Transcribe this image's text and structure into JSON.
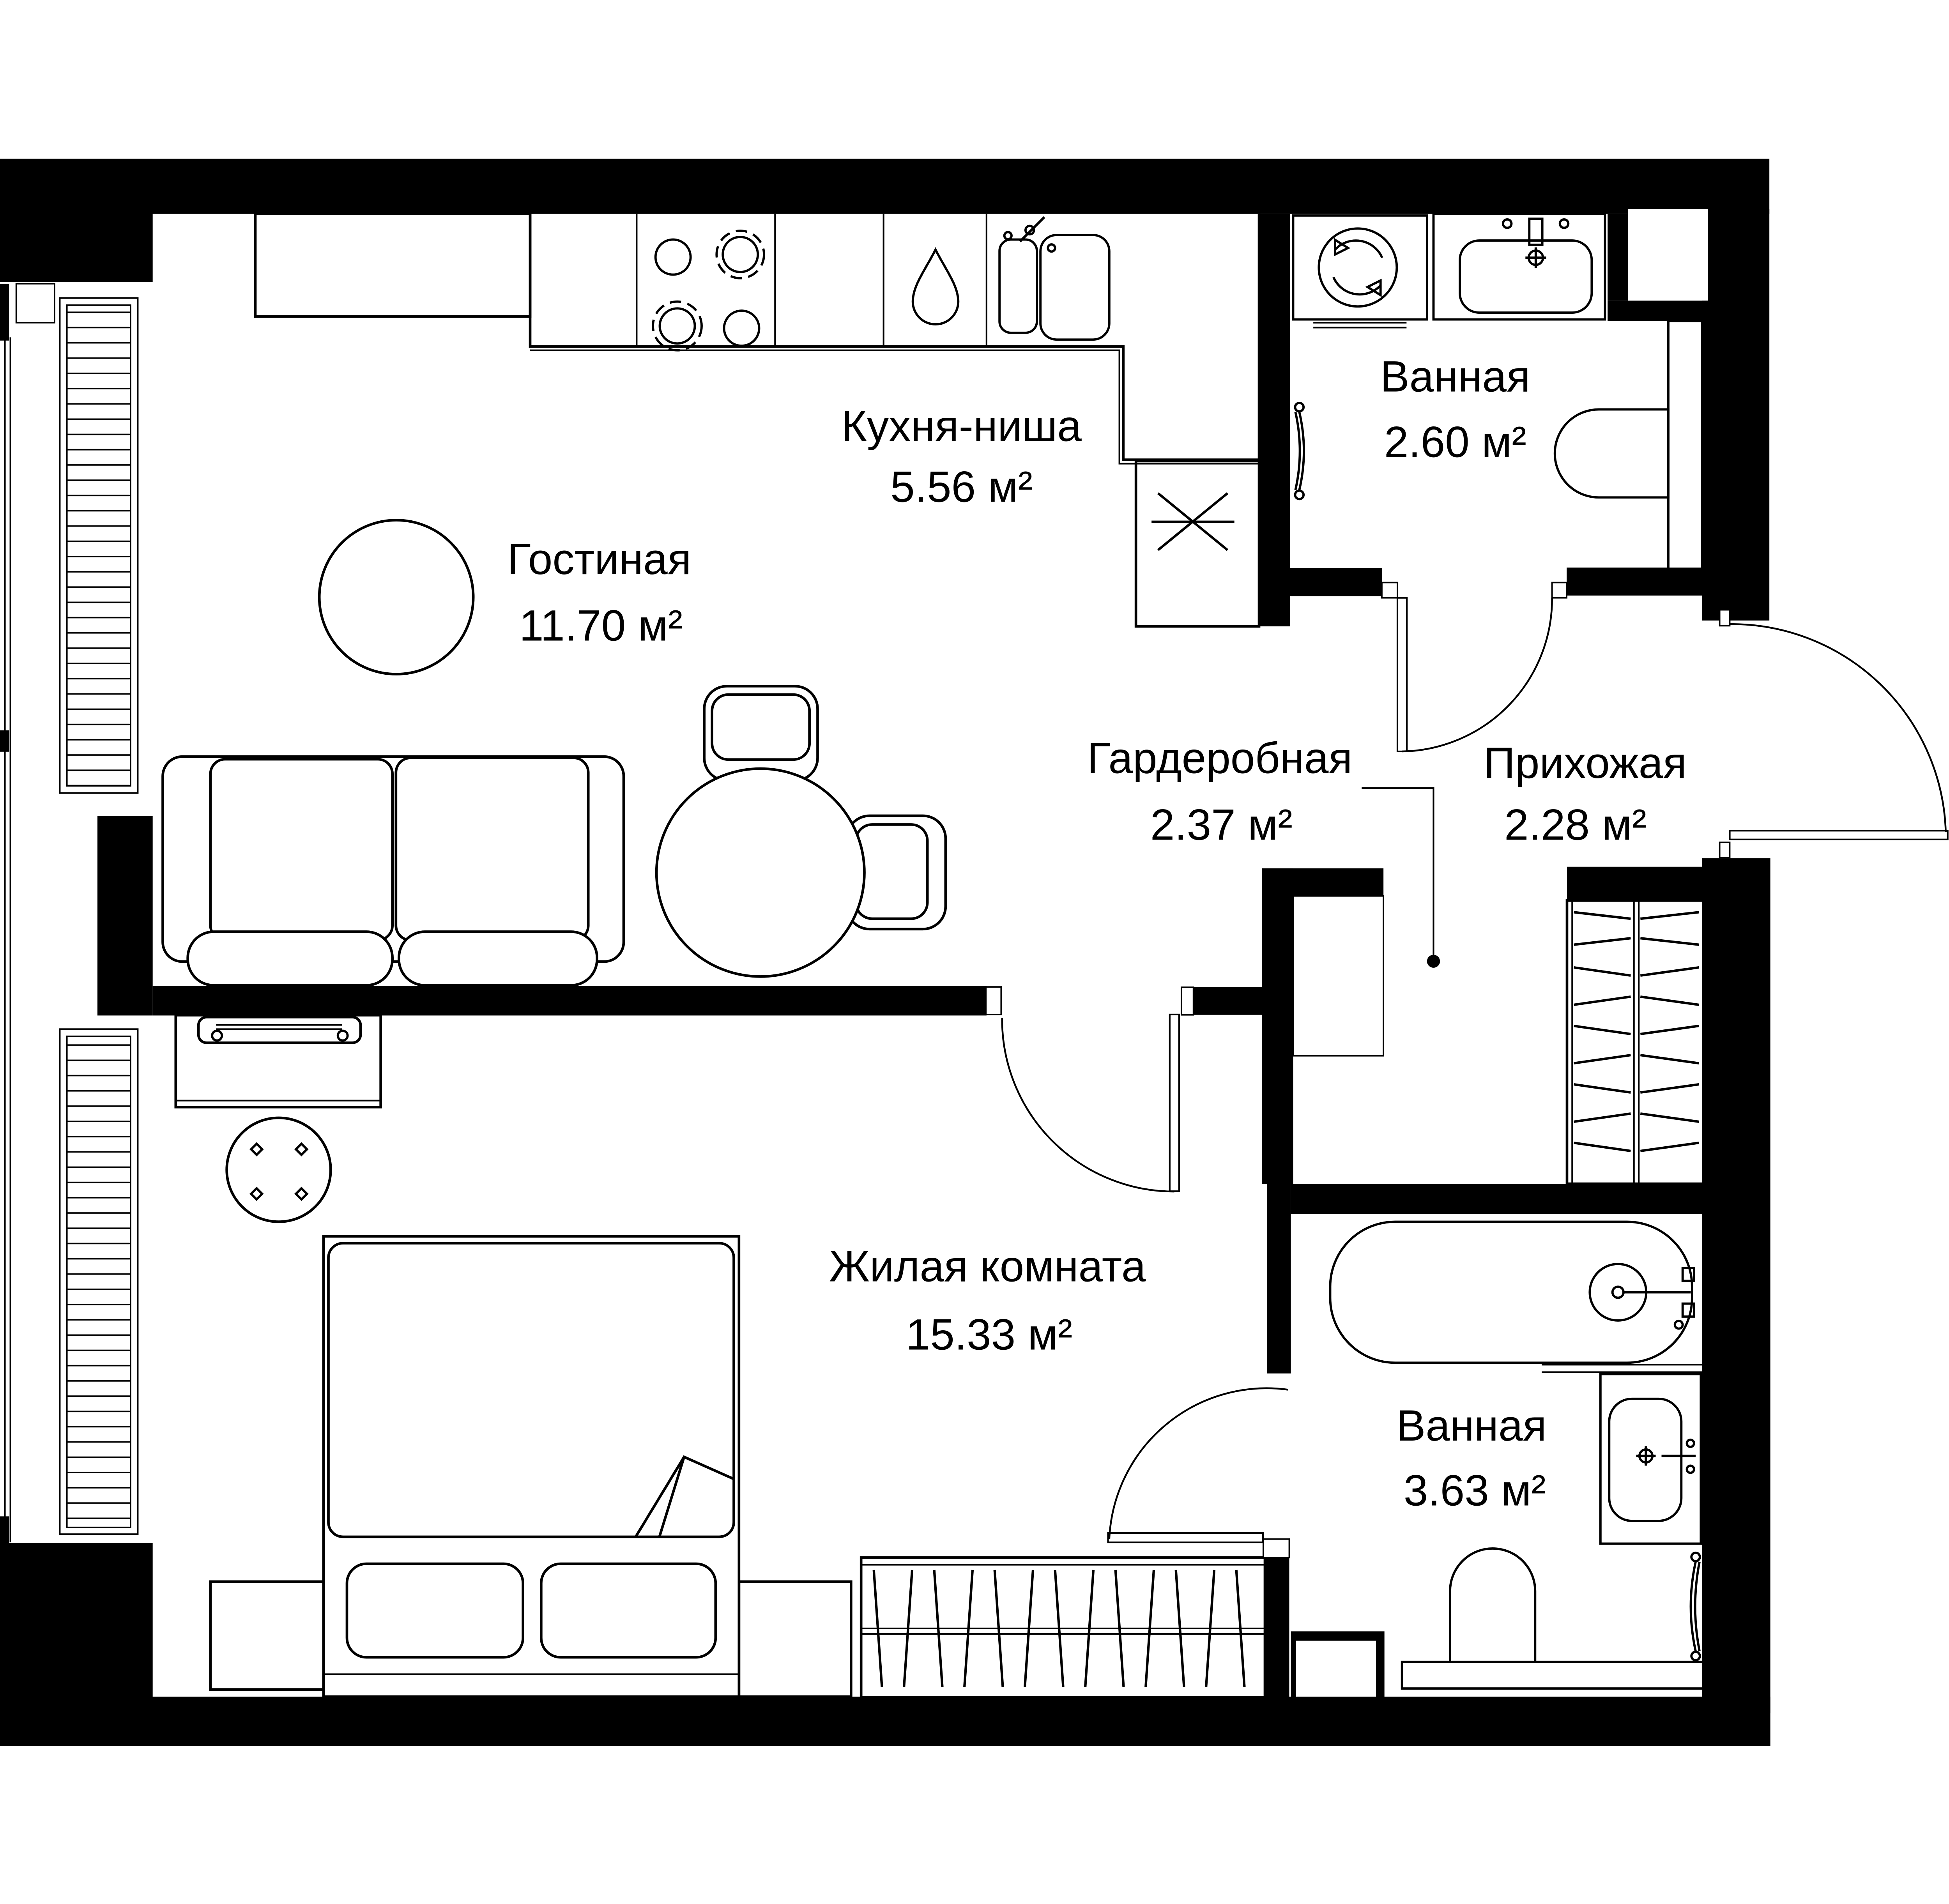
{
  "plan": {
    "title": "Apartment floor plan",
    "units_suffix": "м²",
    "rooms": [
      {
        "id": "kitchen",
        "name": "Кухня-ниша",
        "area": "5.56 м²"
      },
      {
        "id": "living",
        "name": "Гостиная",
        "area": "11.70 м²"
      },
      {
        "id": "bathroom-top",
        "name": "Ванная",
        "area": "2.60 м²"
      },
      {
        "id": "wardrobe-room",
        "name": "Гардеробная",
        "area": "2.37 м²"
      },
      {
        "id": "hallway",
        "name": "Прихожая",
        "area": "2.28 м²"
      },
      {
        "id": "bedroom",
        "name": "Жилая комната",
        "area": "15.33 м²"
      },
      {
        "id": "bathroom-bottom",
        "name": "Ванная",
        "area": "3.63 м²"
      }
    ],
    "colors": {
      "walls": "#000000",
      "background": "#ffffff",
      "lines": "#000000"
    }
  }
}
